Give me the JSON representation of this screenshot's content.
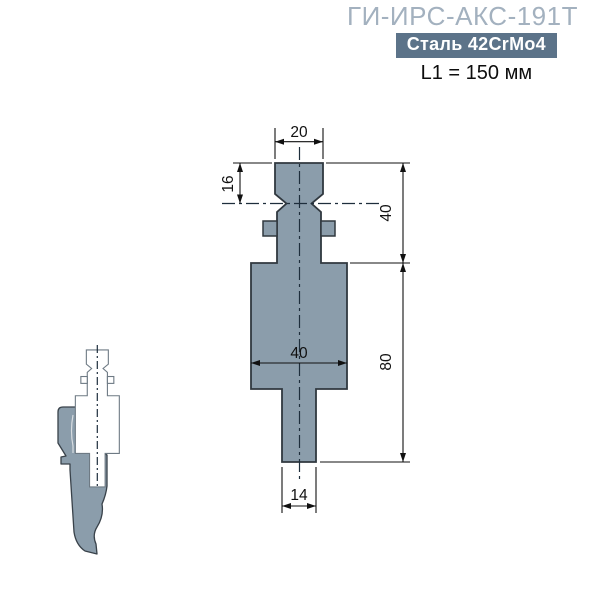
{
  "header": {
    "title": "ГИ-ИРС-АКС-191Т",
    "badge": "Сталь 42CrMo4",
    "length_label": "L1 = 150 мм"
  },
  "drawing": {
    "dimensions": {
      "top_width": "20",
      "neck_height": "16",
      "shank_height": "40",
      "body_width": "40",
      "body_height": "80",
      "stem_width": "14"
    },
    "colors": {
      "part_fill": "#8b9dab",
      "part_outline": "#30383f",
      "title_accent": "#a3b1bf",
      "badge_bg": "#5c7389"
    }
  }
}
